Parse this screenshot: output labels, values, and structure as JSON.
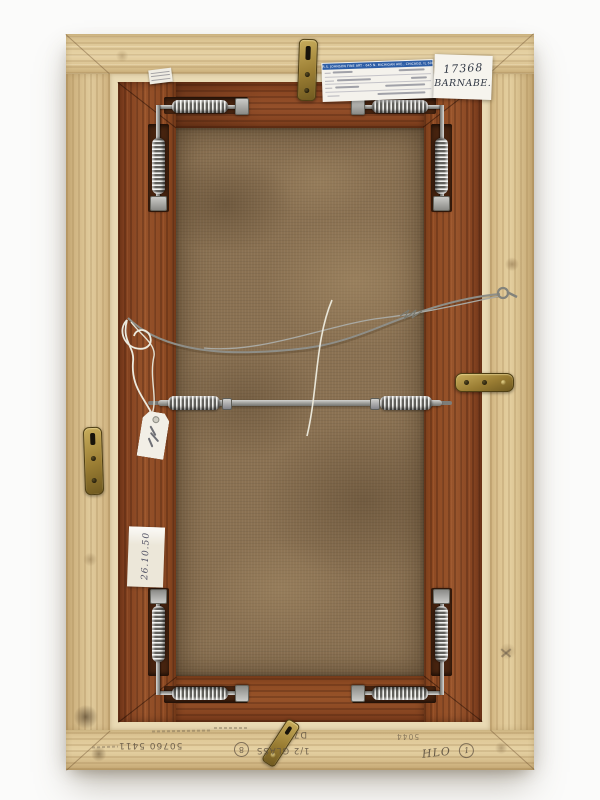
{
  "labels": {
    "framer": {
      "header": "R.S. JOHNSON FINE ART · 645 N. MICHIGAN AVE., CHICAGO, IL 60611-2812 · 312-943"
    },
    "inventory": {
      "number": "17368",
      "name": "BARNABE."
    },
    "date_tag": {
      "text": "26.10.50"
    }
  },
  "pencil": {
    "stock_number": "50760 5411",
    "circled_left": "8",
    "glass_note": "1/2 GLASS",
    "mark_d7": "D7",
    "mark_5044": "5044",
    "mark_hlo": "HLO",
    "circled_right": "1"
  },
  "colors": {
    "brass": "#a8893f",
    "label_header_blue": "#2e5ea6",
    "wood_light": "#d7bd8c",
    "wood_dark": "#8a4a26",
    "canvas_brown": "#8a7152"
  }
}
